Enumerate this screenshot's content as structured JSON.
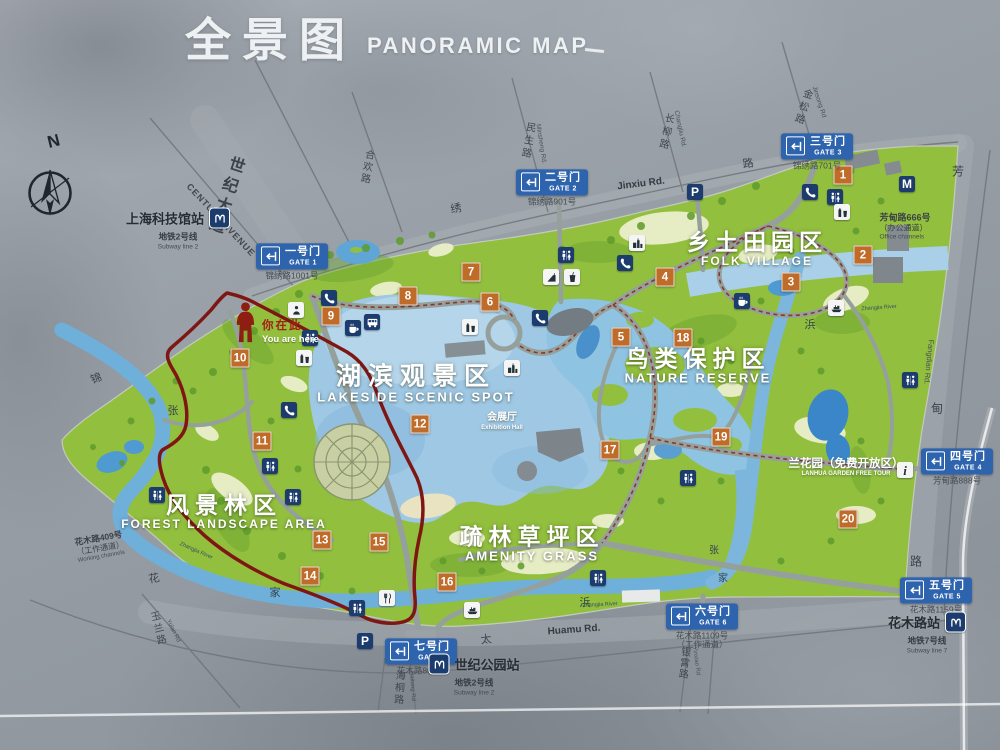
{
  "title": {
    "zh": "全景图",
    "en": "PANORAMIC MAP"
  },
  "compass_label": "N",
  "colors": {
    "park_green": "#92bf3e",
    "lake_blue": "#9fc8e4",
    "river_blue": "#74afd8",
    "gate_sign_blue": "#2e63ae",
    "marker_orange": "#bf6b2a",
    "icon_navy": "#1d3c6e",
    "boundary_red": "#8c2b20",
    "concrete_gray": "#9ba2aa"
  },
  "regions": [
    {
      "zh": "乡土田园区",
      "en": "FOLK VILLAGE",
      "x": 757,
      "y": 249,
      "zs": 23,
      "es": 12,
      "ls": 5
    },
    {
      "zh": "鸟类保护区",
      "en": "NATURE RESERVE",
      "x": 698,
      "y": 366,
      "zs": 23,
      "es": 13,
      "ls": 6
    },
    {
      "zh": "湖滨观景区",
      "en": "LAKESIDE SCENIC SPOT",
      "x": 416,
      "y": 384,
      "zs": 25,
      "es": 13,
      "ls": 7
    },
    {
      "zh": "风景林区",
      "en": "FOREST LANDSCAPE AREA",
      "x": 224,
      "y": 512,
      "zs": 23,
      "es": 12,
      "ls": 6
    },
    {
      "zh": "疏林草坪区",
      "en": "AMENITY GRASS",
      "x": 532,
      "y": 544,
      "zs": 23,
      "es": 13,
      "ls": 6
    }
  ],
  "gates": [
    {
      "zh": "一号门",
      "en": "GATE 1",
      "addr": "锦绣路1001号",
      "x": 292,
      "y": 262
    },
    {
      "zh": "二号门",
      "en": "GATE 2",
      "addr": "锦绣路901号",
      "x": 552,
      "y": 188
    },
    {
      "zh": "三号门",
      "en": "GATE 3",
      "addr": "锦绣路701号",
      "x": 817,
      "y": 152
    },
    {
      "zh": "四号门",
      "en": "GATE 4",
      "addr": "芳甸路888号",
      "x": 957,
      "y": 467
    },
    {
      "zh": "五号门",
      "en": "GATE 5",
      "addr": "花木路1159号",
      "x": 936,
      "y": 596
    },
    {
      "zh": "六号门",
      "en": "GATE 6",
      "addr": "花木路1109号",
      "addr2": "（工作通道）",
      "x": 702,
      "y": 627
    },
    {
      "zh": "七号门",
      "en": "GATE 7",
      "addr": "花木路801号",
      "x": 421,
      "y": 657
    }
  ],
  "stations": [
    {
      "name": "上海科技馆站",
      "line_zh": "地铁2号线",
      "line_en": "Subway line 2",
      "icon_side": "right",
      "x": 178,
      "y": 229
    },
    {
      "name": "世纪公园站",
      "line_zh": "地铁2号线",
      "line_en": "Subway line 2",
      "icon_side": "left",
      "x": 474,
      "y": 675
    },
    {
      "name": "花木路站",
      "line_zh": "地铁7号线",
      "line_en": "Subway line 7",
      "icon_side": "right",
      "x": 927,
      "y": 633
    }
  ],
  "you_are_here": {
    "zh": "你在此",
    "en": "You are here"
  },
  "markers": [
    {
      "n": "1",
      "x": 843,
      "y": 175
    },
    {
      "n": "2",
      "x": 863,
      "y": 255
    },
    {
      "n": "3",
      "x": 791,
      "y": 282
    },
    {
      "n": "4",
      "x": 665,
      "y": 277
    },
    {
      "n": "5",
      "x": 621,
      "y": 337
    },
    {
      "n": "6",
      "x": 490,
      "y": 302
    },
    {
      "n": "7",
      "x": 471,
      "y": 272
    },
    {
      "n": "8",
      "x": 408,
      "y": 296
    },
    {
      "n": "9",
      "x": 331,
      "y": 316
    },
    {
      "n": "10",
      "x": 240,
      "y": 358
    },
    {
      "n": "11",
      "x": 262,
      "y": 441
    },
    {
      "n": "12",
      "x": 420,
      "y": 424
    },
    {
      "n": "13",
      "x": 322,
      "y": 540
    },
    {
      "n": "14",
      "x": 310,
      "y": 576
    },
    {
      "n": "15",
      "x": 379,
      "y": 542
    },
    {
      "n": "16",
      "x": 447,
      "y": 582
    },
    {
      "n": "17",
      "x": 610,
      "y": 450
    },
    {
      "n": "18",
      "x": 683,
      "y": 338
    },
    {
      "n": "19",
      "x": 721,
      "y": 437
    },
    {
      "n": "20",
      "x": 848,
      "y": 519
    }
  ],
  "icons": [
    {
      "t": "parking",
      "x": 319,
      "y": 259
    },
    {
      "t": "parking",
      "x": 695,
      "y": 192
    },
    {
      "t": "parking",
      "x": 365,
      "y": 641
    },
    {
      "t": "phone",
      "x": 329,
      "y": 298
    },
    {
      "t": "phone",
      "x": 289,
      "y": 410
    },
    {
      "t": "phone",
      "x": 625,
      "y": 263
    },
    {
      "t": "phone",
      "x": 540,
      "y": 318
    },
    {
      "t": "phone",
      "x": 810,
      "y": 192
    },
    {
      "t": "restroom",
      "x": 566,
      "y": 255
    },
    {
      "t": "restroom",
      "x": 310,
      "y": 338
    },
    {
      "t": "restroom",
      "x": 157,
      "y": 495
    },
    {
      "t": "restroom",
      "x": 293,
      "y": 497
    },
    {
      "t": "restroom",
      "x": 270,
      "y": 466
    },
    {
      "t": "restroom",
      "x": 835,
      "y": 197
    },
    {
      "t": "restroom",
      "x": 910,
      "y": 380
    },
    {
      "t": "restroom",
      "x": 598,
      "y": 578
    },
    {
      "t": "restroom",
      "x": 357,
      "y": 608
    },
    {
      "t": "restroom",
      "x": 688,
      "y": 478
    },
    {
      "t": "coffee",
      "x": 353,
      "y": 328
    },
    {
      "t": "coffee",
      "x": 742,
      "y": 301
    },
    {
      "t": "bus",
      "x": 372,
      "y": 322
    },
    {
      "t": "vending",
      "x": 470,
      "y": 327
    },
    {
      "t": "vending",
      "x": 304,
      "y": 358
    },
    {
      "t": "vending",
      "x": 842,
      "y": 212
    },
    {
      "t": "boat",
      "x": 836,
      "y": 308
    },
    {
      "t": "boat",
      "x": 472,
      "y": 610
    },
    {
      "t": "building",
      "x": 637,
      "y": 243
    },
    {
      "t": "building",
      "x": 512,
      "y": 368
    },
    {
      "t": "restaurant",
      "x": 387,
      "y": 598
    },
    {
      "t": "playground",
      "x": 551,
      "y": 277
    },
    {
      "t": "drink",
      "x": 572,
      "y": 277
    },
    {
      "t": "info",
      "x": 905,
      "y": 470
    },
    {
      "t": "metroM",
      "x": 907,
      "y": 184
    },
    {
      "t": "kiosk",
      "x": 296,
      "y": 310
    }
  ],
  "road_labels": [
    {
      "t": "世纪大道",
      "x": 224,
      "y": 196,
      "r": 18,
      "s": 16,
      "c": "#3c434a",
      "v": true,
      "ls": 5,
      "b": true
    },
    {
      "t": "CENTURY AVENUE",
      "x": 221,
      "y": 220,
      "r": 47,
      "s": 9,
      "c": "#40474d",
      "ls": 1,
      "b": true
    },
    {
      "t": "合欢路",
      "x": 366,
      "y": 167,
      "r": 10,
      "s": 10,
      "c": "#40474d",
      "v": true,
      "ls": 2
    },
    {
      "t": "民生路",
      "x": 527,
      "y": 141,
      "r": 10,
      "s": 10,
      "c": "#40474d",
      "v": true,
      "ls": 3
    },
    {
      "t": "Minsheng Rd.",
      "x": 541,
      "y": 144,
      "r": 81,
      "s": 6.5,
      "c": "#4a5157"
    },
    {
      "t": "长柳路",
      "x": 665,
      "y": 132,
      "r": 12,
      "s": 10,
      "c": "#40474d",
      "v": true,
      "ls": 3
    },
    {
      "t": "Changliu Rd.",
      "x": 680,
      "y": 129,
      "r": 78,
      "s": 6.5,
      "c": "#4a5157"
    },
    {
      "t": "金松路",
      "x": 802,
      "y": 107,
      "r": 18,
      "s": 10,
      "c": "#40474d",
      "v": true,
      "ls": 3
    },
    {
      "t": "Jinsong Rd",
      "x": 819,
      "y": 102,
      "r": 72,
      "s": 6.5,
      "c": "#4a5157"
    },
    {
      "t": "Jinxiu Rd.",
      "x": 641,
      "y": 184,
      "r": -7,
      "s": 10,
      "c": "#343b41",
      "b": true
    },
    {
      "t": "锦",
      "x": 96,
      "y": 378,
      "r": -20,
      "s": 11,
      "c": "#3c434a"
    },
    {
      "t": "绣",
      "x": 456,
      "y": 208,
      "r": -10,
      "s": 11,
      "c": "#3c434a"
    },
    {
      "t": "路",
      "x": 748,
      "y": 163,
      "r": -8,
      "s": 11,
      "c": "#3c434a"
    },
    {
      "t": "芳",
      "x": 958,
      "y": 171,
      "s": 12,
      "c": "#3c434a"
    },
    {
      "t": "Fangdian Rd.",
      "x": 929,
      "y": 362,
      "r": 96,
      "s": 7.5,
      "c": "#4a5157"
    },
    {
      "t": "甸",
      "x": 937,
      "y": 408,
      "s": 12,
      "c": "#3c434a"
    },
    {
      "t": "路",
      "x": 916,
      "y": 561,
      "s": 12,
      "c": "#3c434a"
    },
    {
      "t": "Huamu Rd.",
      "x": 574,
      "y": 630,
      "r": -4,
      "s": 10,
      "c": "#343b41",
      "b": true
    },
    {
      "t": "海桐路",
      "x": 398,
      "y": 688,
      "r": 4,
      "s": 10,
      "c": "#40474d",
      "v": true,
      "ls": 2
    },
    {
      "t": "Haitong Rd",
      "x": 412,
      "y": 686,
      "r": 86,
      "s": 6,
      "c": "#4a5157"
    },
    {
      "t": "玉兰路",
      "x": 157,
      "y": 629,
      "r": -14,
      "s": 10,
      "c": "#40474d",
      "v": true,
      "ls": 2
    },
    {
      "t": "Yulan Rd",
      "x": 173,
      "y": 631,
      "r": 64,
      "s": 6,
      "c": "#4a5157"
    },
    {
      "t": "银霄路",
      "x": 683,
      "y": 663,
      "r": 6,
      "s": 10,
      "c": "#40474d",
      "v": true,
      "ls": 1
    },
    {
      "t": "Yinxiao Rd",
      "x": 696,
      "y": 661,
      "r": 82,
      "s": 6,
      "c": "#4a5157"
    },
    {
      "t": "太",
      "x": 486,
      "y": 639,
      "r": -6,
      "s": 11,
      "c": "#3c434a"
    },
    {
      "t": "花",
      "x": 154,
      "y": 578,
      "r": -10,
      "s": 11,
      "c": "#3c434a"
    },
    {
      "t": "张",
      "x": 173,
      "y": 410,
      "s": 11,
      "c": "#34454f"
    },
    {
      "t": "家",
      "x": 275,
      "y": 592,
      "s": 11,
      "c": "#34454f"
    },
    {
      "t": "浜",
      "x": 585,
      "y": 602,
      "s": 11,
      "c": "#34454f"
    },
    {
      "t": "浜",
      "x": 810,
      "y": 324,
      "s": 11,
      "c": "#34454f"
    },
    {
      "t": "张",
      "x": 714,
      "y": 549,
      "s": 10,
      "c": "#34454f"
    },
    {
      "t": "家",
      "x": 723,
      "y": 577,
      "s": 10,
      "c": "#34454f"
    },
    {
      "t": "Zhangjia River",
      "x": 600,
      "y": 605,
      "r": -3,
      "s": 5.5,
      "c": "#35505e"
    },
    {
      "t": "Zhangjia River",
      "x": 196,
      "y": 551,
      "r": 24,
      "s": 5.5,
      "c": "#35505e"
    },
    {
      "t": "Zhangjia River",
      "x": 879,
      "y": 308,
      "r": -4,
      "s": 5.5,
      "c": "#35505e"
    }
  ],
  "annotations": [
    {
      "name": "office-channel-note",
      "x": 905,
      "y": 227,
      "align": "left",
      "lines": [
        {
          "t": "芳甸路666号",
          "s": 9,
          "c": "#3a4147",
          "b": true
        },
        {
          "t": "（办公通道）",
          "s": 8,
          "c": "#3a4147"
        },
        {
          "t": "Office channels",
          "s": 6.5,
          "c": "#454c52"
        }
      ]
    },
    {
      "name": "working-channel-note",
      "x": 100,
      "y": 547,
      "r": -10,
      "align": "left",
      "lines": [
        {
          "t": "花木路409号",
          "s": 8.5,
          "c": "#3a4147",
          "b": true
        },
        {
          "t": "（工作通道）",
          "s": 8,
          "c": "#3a4147"
        },
        {
          "t": "Working channels",
          "s": 6,
          "c": "#454c52"
        }
      ]
    },
    {
      "name": "lanhua-garden-note",
      "x": 846,
      "y": 468,
      "lines": [
        {
          "t": "兰花园（免费开放区）",
          "s": 11.5,
          "c": "#ffffff",
          "b": true,
          "w": true
        },
        {
          "t": "LANHUA GARDEN FREE TOUR",
          "s": 6,
          "c": "#ffffff",
          "b": true,
          "w": true
        }
      ]
    },
    {
      "name": "exhibition-hall-note",
      "x": 502,
      "y": 422,
      "lines": [
        {
          "t": "会展厅",
          "s": 10,
          "c": "#ffffff",
          "b": true,
          "w": true
        },
        {
          "t": "Exhibition Hall",
          "s": 6,
          "c": "#ffffff",
          "b": true,
          "w": true
        }
      ]
    }
  ]
}
